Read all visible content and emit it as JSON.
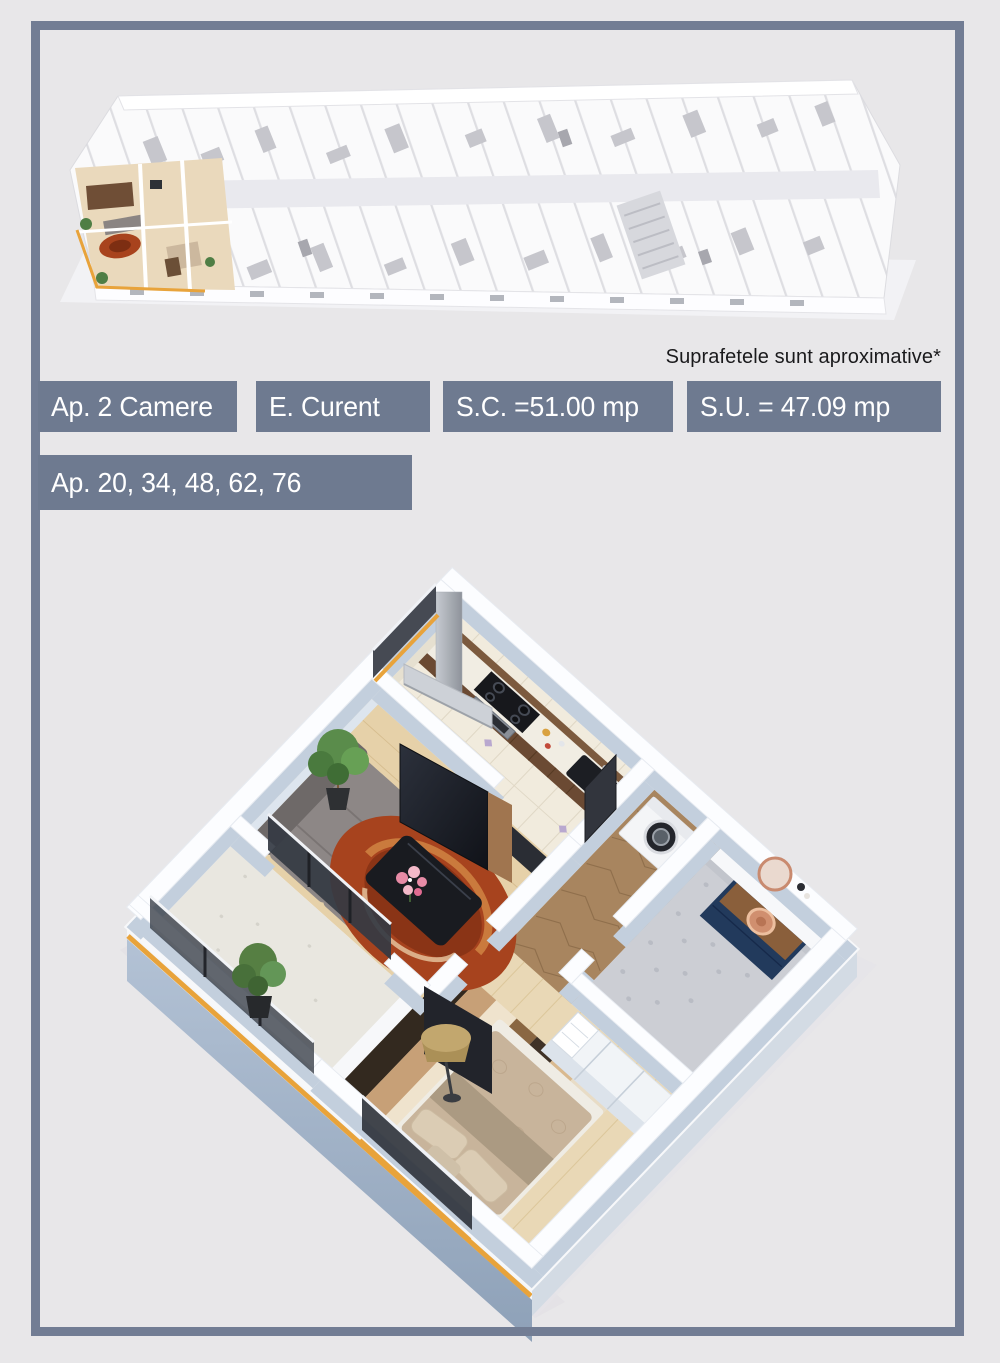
{
  "flyer": {
    "disclaimer": "Suprafetele sunt aproximative*",
    "badges": {
      "rooms": "Ap. 2 Camere",
      "utilities": "E. Curent",
      "built_surface": "S.C. =51.00 mp",
      "usable_surface": "S.U. = 47.09 mp",
      "apartment_numbers": "Ap. 20, 34, 48, 62, 76"
    },
    "colors": {
      "background": "#E8E7E9",
      "frame_border": "#727D94",
      "badge_background": "#6E7A90",
      "badge_text": "#FFFFFF",
      "accent_orange": "#E8A33B",
      "disclaimer_text": "#1A1A1C"
    }
  }
}
